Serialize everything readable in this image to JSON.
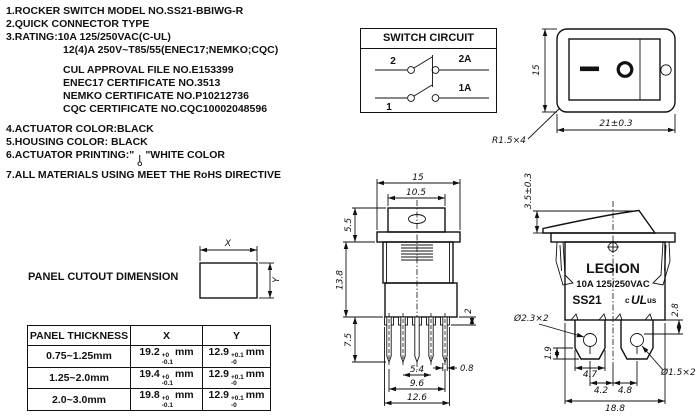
{
  "specs": {
    "line1": "1.ROCKER SWITCH MODEL NO.SS21-BBIWG-R",
    "line2": "2.QUICK CONNECTOR TYPE",
    "line3": "3.RATING:10A 125/250VAC(C-UL)",
    "line3b": "12(4)A 250V~T85/55(ENEC17;NEMKO;CQC)",
    "cert1": "CUL APPROVAL FILE NO.E153399",
    "cert2": "ENEC17 CERTIFICATE NO.3513",
    "cert3": "NEMKO CERTIFICATE NO.P10212736",
    "cert4": "CQC CERTIFICATE NO.CQC10002048596",
    "line4": "4.ACTUATOR COLOR:BLACK",
    "line5": "5.HOUSING COLOR: BLACK",
    "line6_prefix": "6.ACTUATOR PRINTING:\"",
    "line6_symbol_on": "|",
    "line6_symbol_off": "O",
    "line6_suffix": "\"WHITE COLOR",
    "line7": "7.ALL MATERIALS USING MEET THE RoHS DIRECTIVE"
  },
  "circuit": {
    "title": "SWITCH CIRCUIT",
    "t2": "2",
    "t2a": "2A",
    "t1": "1",
    "t1a": "1A"
  },
  "front_view": {
    "h": "15",
    "w": "21±0.3",
    "r": "R1.5×4",
    "off_mark": "O",
    "on_mark": "—"
  },
  "panel_cutout": {
    "title": "PANEL CUTOUT DIMENSION",
    "x": "X",
    "y": "Y"
  },
  "table": {
    "headers": [
      "PANEL THICKNESS",
      "X",
      "Y"
    ],
    "rows": [
      {
        "thickness": "0.75~1.25mm",
        "x": "19.2",
        "x_tol_top": "+0",
        "x_tol_bot": "-0.1",
        "y": "12.9",
        "y_tol_top": "+0.1",
        "y_tol_bot": "-0",
        "unit": "mm"
      },
      {
        "thickness": "1.25~2.0mm",
        "x": "19.4",
        "x_tol_top": "+0",
        "x_tol_bot": "-0.1",
        "y": "12.9",
        "y_tol_top": "+0.1",
        "y_tol_bot": "-0",
        "unit": "mm"
      },
      {
        "thickness": "2.0~3.0mm",
        "x": "19.8",
        "x_tol_top": "+0",
        "x_tol_bot": "-0.1",
        "y": "12.9",
        "y_tol_top": "+0.1",
        "y_tol_bot": "-0",
        "unit": "mm"
      }
    ]
  },
  "end_view": {
    "w": "15",
    "w_inner": "10.5",
    "h_top": "5.5",
    "h_body": "13.8",
    "h_pin": "7.5",
    "step": "2",
    "pin_t": "0.8",
    "p1": "5.4",
    "p2": "9.6",
    "p3": "12.6"
  },
  "side_view": {
    "brand": "LEGION",
    "rating": "10A 125/250VAC",
    "model": "SS21",
    "ul_prefix": "c",
    "ul_mark": "UL",
    "ul_suffix": "us",
    "h_rocker": "3.5±0.3",
    "hole_big": "Ø2.3×2",
    "hole_small": "Ø1.5×2",
    "d28": "2.8",
    "d19": "1.9",
    "d47": "4.7",
    "d42": "4.2",
    "d48": "4.8",
    "d188": "18.8"
  }
}
